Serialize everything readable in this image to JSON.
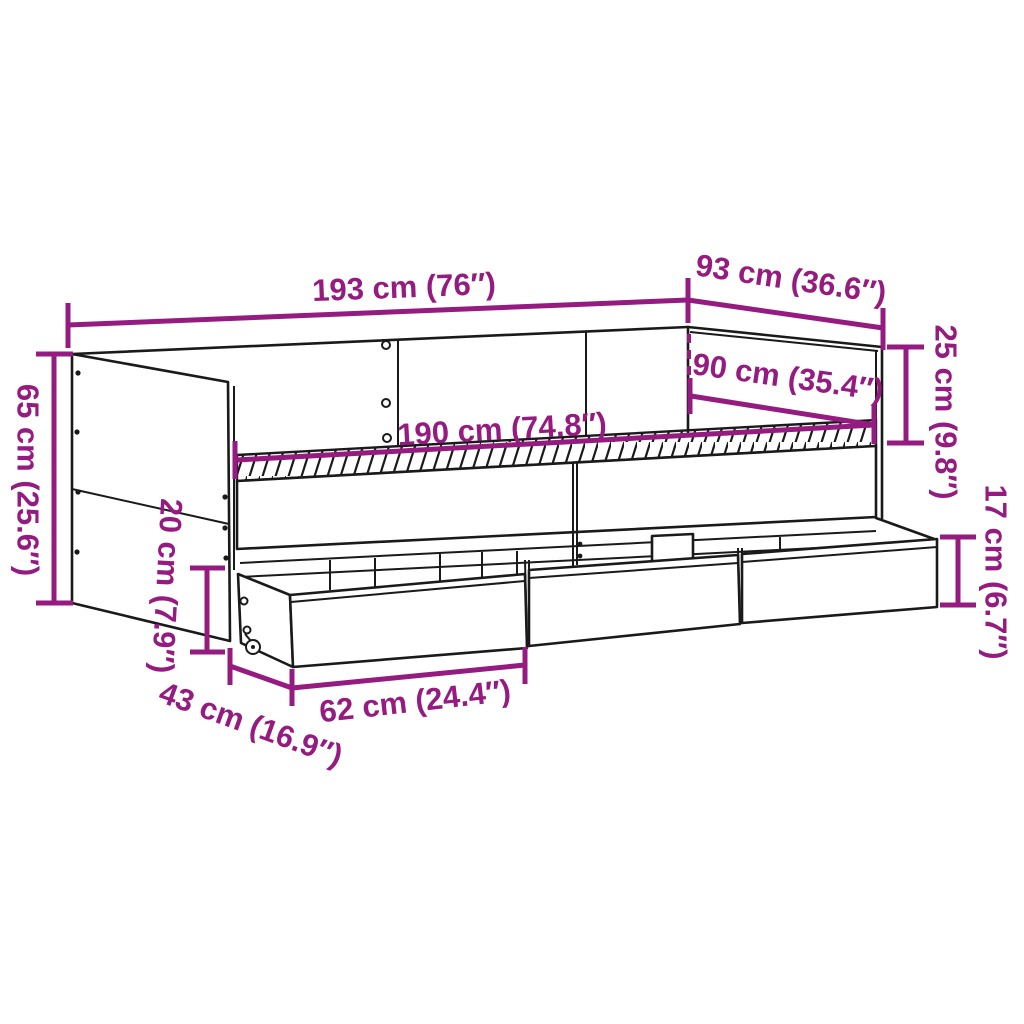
{
  "diagram": {
    "type": "product-dimension-line-drawing",
    "subject": "daybed with three storage drawers and casters",
    "background_color": "#FFFFFF",
    "outline_color": "#1A1A1A",
    "accent_color": "#951B81",
    "dimensions": {
      "total_length": "193 cm (76″)",
      "total_depth": "93 cm (36.6″)",
      "total_height": "65 cm (25.6″)",
      "back_height_above_base": "25 cm (9.8″)",
      "mattress_length": "190 cm (74.8″)",
      "mattress_depth": "90 cm (35.4″)",
      "under_bed_clearance": "20 cm (7.9″)",
      "drawer_height": "17 cm (6.7″)",
      "drawer_depth": "43 cm (16.9″)",
      "drawer_length": "62 cm (24.4″)"
    }
  }
}
